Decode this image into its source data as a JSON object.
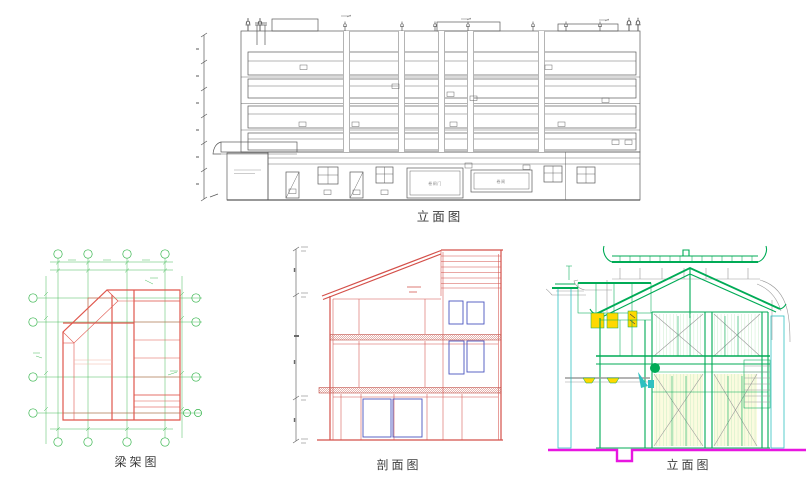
{
  "page": {
    "background": "#ffffff"
  },
  "captions": {
    "top_elevation": "立面图",
    "beam_frame": "梁架图",
    "section": "剖面图",
    "right_elevation": "立面图"
  },
  "top_elevation": {
    "shutter_door_label": "卷闸门",
    "shutter_label": "卷闸"
  },
  "palette": {
    "paper": "#ffffff",
    "ink": "#5a5a5a",
    "green": "#33b44a",
    "red": "#e0584e",
    "hatch": "#edaa94",
    "sred": "#d4504a",
    "blue": "#4a55c0",
    "tgreen": "#00ab56",
    "yellow": "#ffd800",
    "cyan": "#2fc0c0",
    "magenta": "#e816e0"
  }
}
